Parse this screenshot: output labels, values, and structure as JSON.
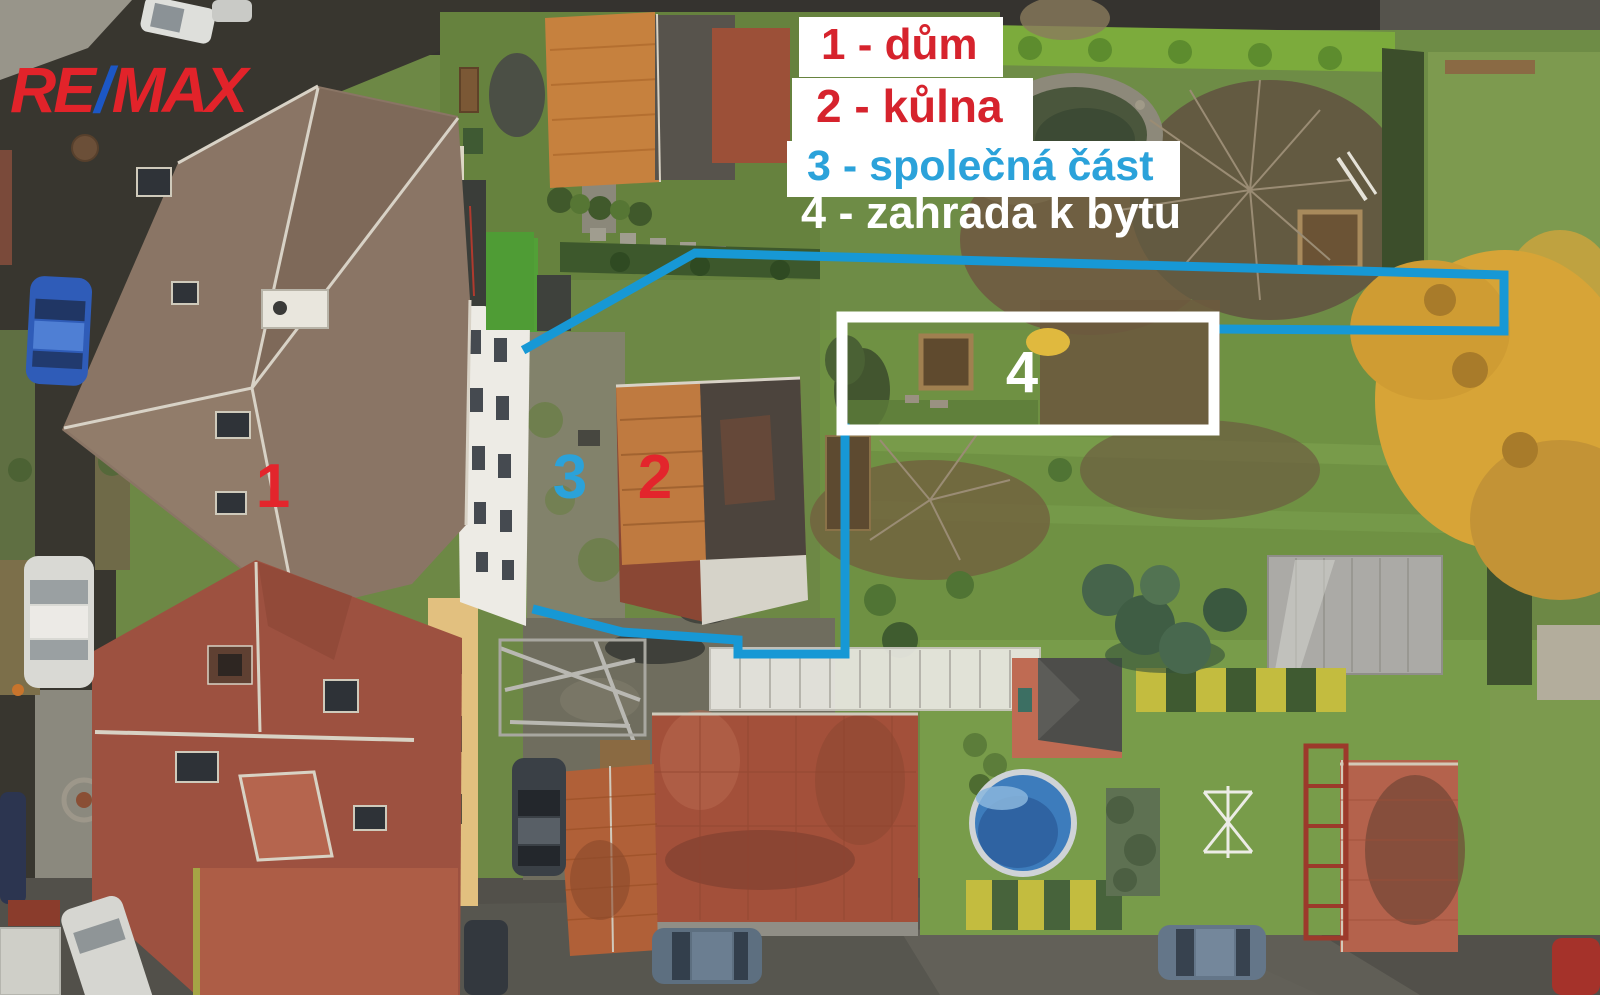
{
  "annotations": {
    "logo": {
      "re": "RE",
      "slash": "/",
      "max": "MAX",
      "red": "#e2232a",
      "blue": "#1c57c5"
    },
    "legend": [
      {
        "id": "1",
        "label": "1 - dům",
        "color": "#d6232d",
        "boxed": true
      },
      {
        "id": "2",
        "label": "2 - kůlna",
        "color": "#d6232d",
        "boxed": true
      },
      {
        "id": "3",
        "label": "3 - společná část",
        "color": "#2ba2da",
        "boxed": true
      },
      {
        "id": "4",
        "label": "4 - zahrada k bytu",
        "color": "#ffffff",
        "boxed": false
      }
    ],
    "markers": [
      {
        "id": "1",
        "color": "#e3252c"
      },
      {
        "id": "2",
        "color": "#e3252c"
      },
      {
        "id": "3",
        "color": "#2ba2da"
      },
      {
        "id": "4",
        "color": "#ffffff"
      }
    ],
    "boundary_color": "#1798d5",
    "area_rect_color": "#ffffff"
  }
}
